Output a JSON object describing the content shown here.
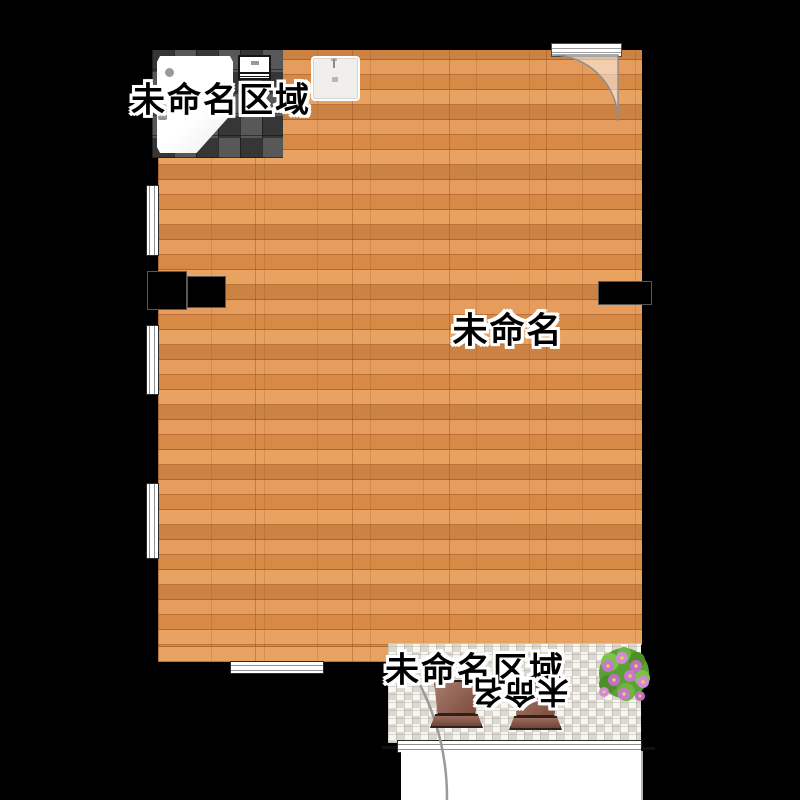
{
  "app": {
    "type": "floor-plan-canvas",
    "background": "#000000"
  },
  "rooms": {
    "top_area": {
      "label": "未命名区域",
      "floor": "dark-mosaic-tile"
    },
    "main": {
      "label": "未命名",
      "floor": "wood-plank"
    },
    "balcony": {
      "label": "未命名区域",
      "flipped_label": "未命名",
      "floor": "light-mosaic-tile"
    }
  },
  "objects": {
    "fixtures": [
      "shower-enclosure",
      "oven",
      "kitchen-sink"
    ],
    "furniture": [
      "cabinet-block-left-a",
      "cabinet-block-left-b",
      "cabinet-block-right"
    ],
    "decor": [
      "planter-pot-1",
      "planter-pot-2",
      "flower-plant"
    ],
    "openings": [
      "entry-door-top-right",
      "balcony-door",
      "window-left-1",
      "window-left-2",
      "window-left-3",
      "window-bottom",
      "balcony-window-band"
    ]
  },
  "colors": {
    "wood_base": "#e2914a",
    "wood_seam": "#964a1a",
    "tile_dark": "#454545",
    "tile_light": "#eceae3",
    "pot_brown": "#7c4c3d",
    "flower_purple": "#c06ec8",
    "flower_center": "#e8d44d",
    "leaf_green": "#5aa032",
    "label_fill": "#000000",
    "label_outline": "#ffffff"
  }
}
